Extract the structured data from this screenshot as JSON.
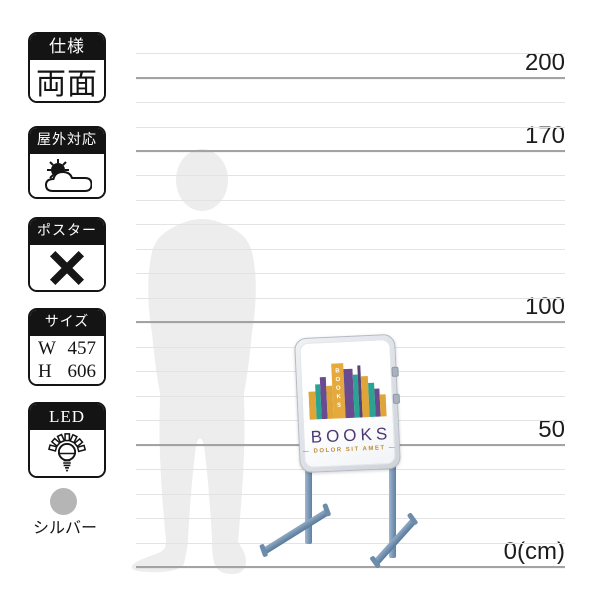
{
  "spec_badges": [
    {
      "header": "仕様",
      "body": "両面"
    },
    {
      "header": "屋外対応",
      "icon": "sun-cloud-icon"
    },
    {
      "header": "ポスター",
      "icon": "cross-icon"
    },
    {
      "header": "サイズ",
      "rows": [
        {
          "label": "W",
          "value": "457"
        },
        {
          "label": "H",
          "value": "606"
        }
      ]
    },
    {
      "header": "LED",
      "icon": "led-bulb-icon"
    }
  ],
  "color_option": {
    "label": "シルバー",
    "swatch_color": "#b5b5b5"
  },
  "ruler": {
    "unit": "cm",
    "max_cm": 210,
    "step_cm": 10,
    "labeled_marks": [
      {
        "cm": 200,
        "label": "200"
      },
      {
        "cm": 170,
        "label": "170"
      },
      {
        "cm": 100,
        "label": "100"
      },
      {
        "cm": 50,
        "label": "50"
      },
      {
        "cm": 0,
        "label": "0(cm)"
      }
    ],
    "line_color_minor": "#e3e3e3",
    "line_color_major": "#a3a3a3"
  },
  "product_sign": {
    "logo_title": "BOOKS",
    "logo_vertical_text": "BOOKS",
    "logo_subtitle": "— DOLOR SIT AMET —",
    "title_color": "#4e3a72",
    "subtitle_color": "#bd8d35",
    "frame_color": "#d6dae0",
    "leg_color": "#7f9cbc",
    "logo_books_bars": [
      {
        "x": 0,
        "w": 7,
        "h": 28,
        "color": "#e0a538"
      },
      {
        "x": 7,
        "w": 5,
        "h": 35,
        "color": "#2aa392"
      },
      {
        "x": 12,
        "w": 6,
        "h": 42,
        "color": "#6a4b8f"
      },
      {
        "x": 18,
        "w": 6,
        "h": 33,
        "color": "#e0a538"
      },
      {
        "x": 24,
        "w": 12,
        "h": 55,
        "color": "#e6a93c",
        "vertical_text": true
      },
      {
        "x": 36,
        "w": 9,
        "h": 49,
        "color": "#6a4b8f"
      },
      {
        "x": 45,
        "w": 5,
        "h": 43,
        "color": "#2aa392"
      },
      {
        "x": 50,
        "w": 3,
        "h": 52,
        "color": "#55437a"
      },
      {
        "x": 53,
        "w": 7,
        "h": 41,
        "color": "#e0a538"
      },
      {
        "x": 60,
        "w": 6,
        "h": 34,
        "color": "#2aa392"
      },
      {
        "x": 66,
        "w": 5,
        "h": 28,
        "color": "#6a4b8f"
      },
      {
        "x": 71,
        "w": 6,
        "h": 22,
        "color": "#e0a538"
      }
    ]
  }
}
